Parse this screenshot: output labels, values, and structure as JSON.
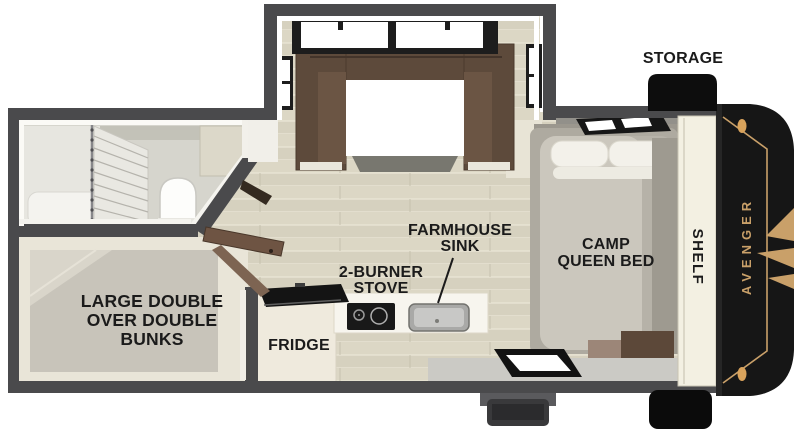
{
  "page": {
    "title": "Avenger travel trailer floor plan",
    "background": "#ffffff"
  },
  "labels": {
    "storage": "STORAGE",
    "shelf": "SHELF",
    "brand": "AVENGER",
    "farmhouse_sink": {
      "line1": "FARMHOUSE",
      "line2": "SINK"
    },
    "stove": {
      "line1": "2-BURNER",
      "line2": "STOVE"
    },
    "fridge": "FRIDGE",
    "bunks": {
      "line1": "LARGE DOUBLE",
      "line2": "OVER DOUBLE",
      "line3": "BUNKS"
    },
    "bed": {
      "line1": "CAMP",
      "line2": "QUEEN BED"
    }
  },
  "colors": {
    "wall_dark": "#4a4a4c",
    "floor_plank": "#dbd6c4",
    "interior_cream": "#e9e5d8",
    "sofa_brown": "#5d4a3b",
    "mattress_gray": "#c9c5bb",
    "label_black": "#1b1b1b",
    "cap_black": "#161616",
    "accent_gold": "#c9a069"
  },
  "features": [
    "dinette-slide-out",
    "shower",
    "toilet",
    "double-bunks",
    "fridge",
    "two-burner-stove",
    "farmhouse-sink",
    "camp-queen-bed",
    "shelf",
    "storage-box",
    "entry-step",
    "entry-mat",
    "rear-cap",
    "roof-vent"
  ]
}
